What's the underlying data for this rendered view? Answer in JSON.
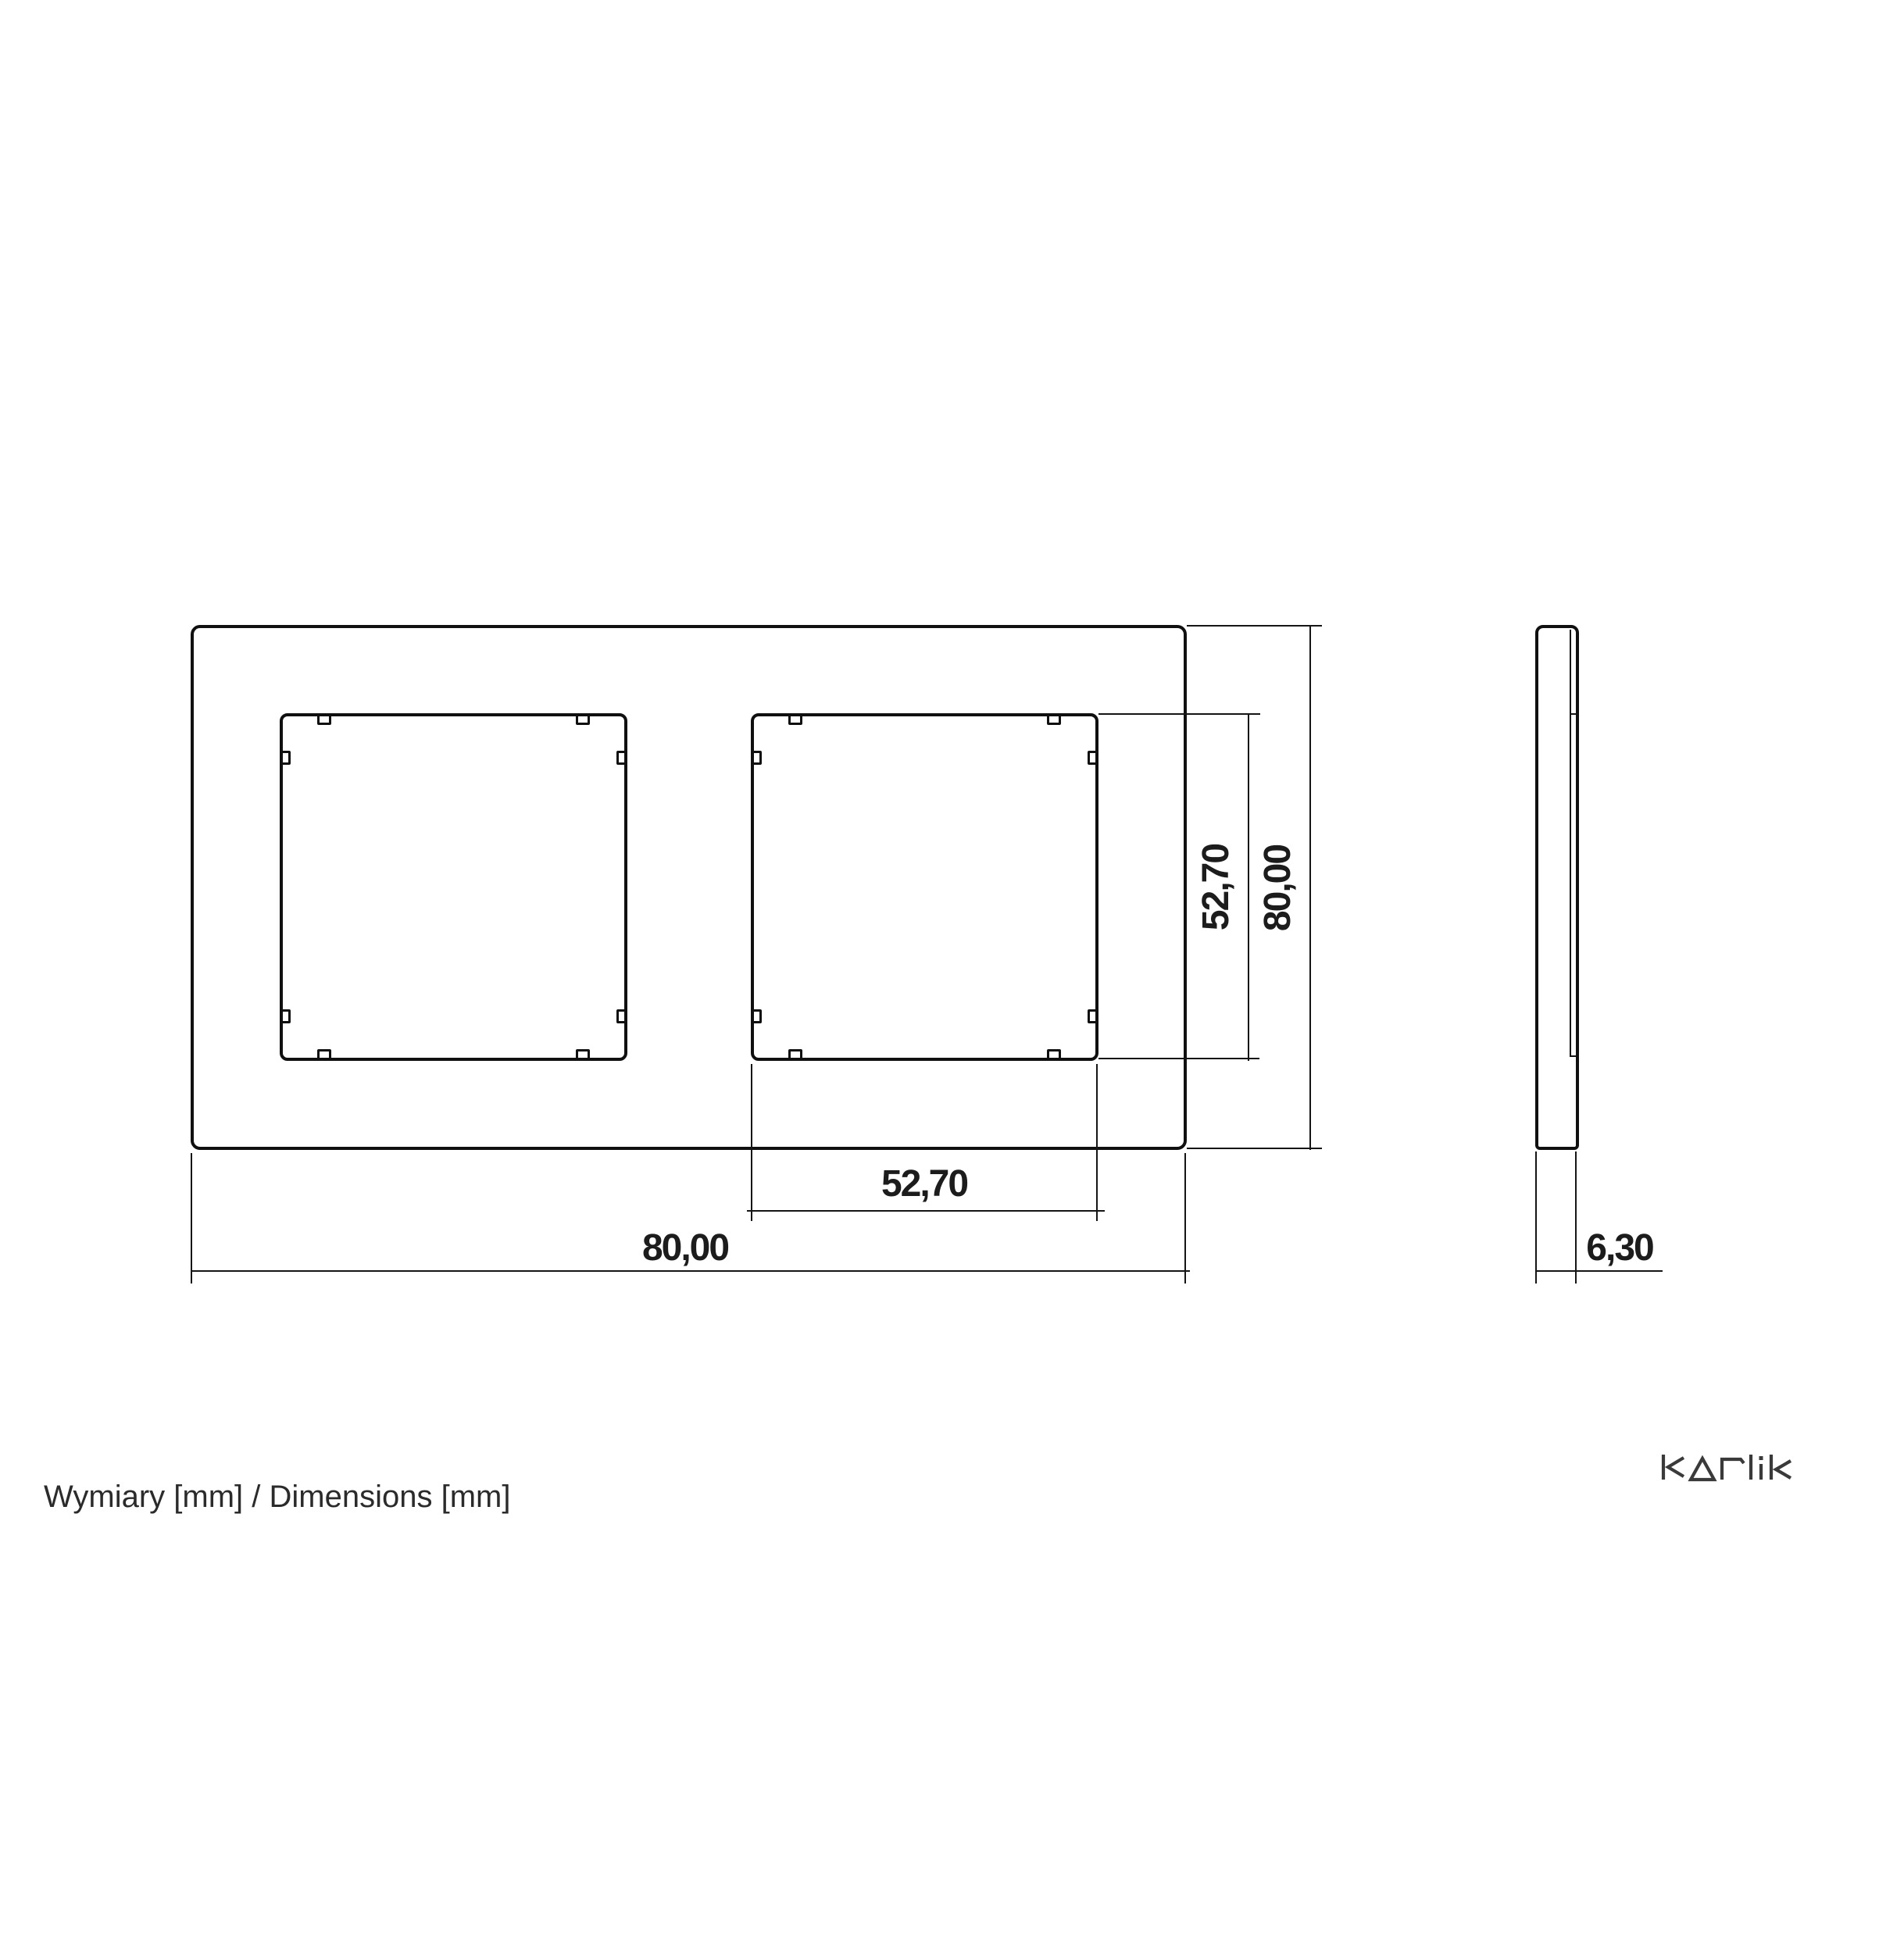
{
  "drawing": {
    "footer_note": "Wymiary [mm] / Dimensions [mm]",
    "brand": "karlik",
    "colors": {
      "line": "#101010",
      "text": "#1c1c1c",
      "muted_text": "#2b2b2b",
      "background": "#ffffff"
    },
    "dimensions": {
      "opening_width": {
        "value": "52,70"
      },
      "frame_width": {
        "value": "80,00"
      },
      "opening_height": {
        "value": "52,70"
      },
      "frame_height": {
        "value": "80,00"
      },
      "thickness": {
        "value": "6,30"
      }
    }
  }
}
